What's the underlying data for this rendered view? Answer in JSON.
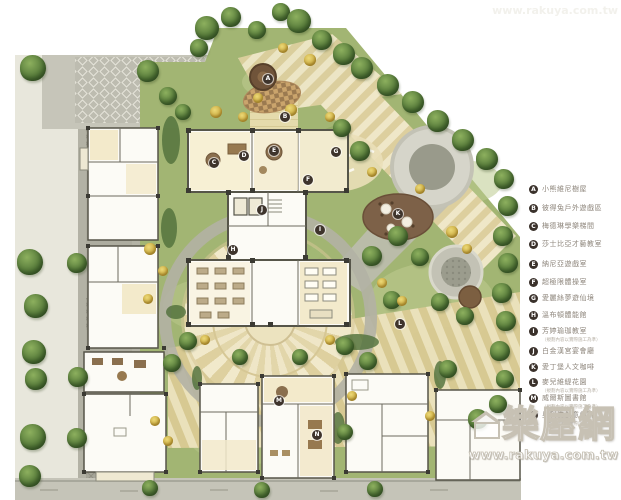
{
  "legend": {
    "items": [
      {
        "letter": "A",
        "label": "小熊維尼樹屋",
        "y": 185
      },
      {
        "letter": "B",
        "label": "彼得兔戶外遊戲區",
        "y": 204
      },
      {
        "letter": "C",
        "label": "梅德琳學樂梯間",
        "y": 222
      },
      {
        "letter": "D",
        "label": "莎士比亞才藝教室",
        "y": 240
      },
      {
        "letter": "E",
        "label": "納尼亞遊戲室",
        "y": 260
      },
      {
        "letter": "F",
        "label": "超極限體操室",
        "y": 278
      },
      {
        "letter": "G",
        "label": "愛麗絲夢遊仙境",
        "y": 294
      },
      {
        "letter": "H",
        "label": "溫布頓體能館",
        "y": 311
      },
      {
        "letter": "I",
        "label": "芳婷瑜珈教室",
        "caption": "（規劃內容以實際施工為準）",
        "y": 327
      },
      {
        "letter": "J",
        "label": "白金漢宮宴會廳",
        "y": 347
      },
      {
        "letter": "K",
        "label": "愛丁堡人文咖啡",
        "y": 363
      },
      {
        "letter": "L",
        "label": "麥兒維緹花園",
        "caption": "（規劃內容以實際施工為準）",
        "y": 378
      },
      {
        "letter": "M",
        "label": "威爾斯圖書館",
        "caption": "（規劃內容以實際施工為準）",
        "y": 394
      },
      {
        "letter": "N",
        "label": "奧利佛創意劇院",
        "caption": "（規劃內容以實際施工為準）",
        "y": 411
      }
    ]
  },
  "watermark": {
    "brand": "樂屋網",
    "url": "www.rakuya.com.tw"
  },
  "plan": {
    "markers": [
      {
        "letter": "A",
        "x": 268,
        "y": 79
      },
      {
        "letter": "B",
        "x": 285,
        "y": 117
      },
      {
        "letter": "C",
        "x": 214,
        "y": 163
      },
      {
        "letter": "D",
        "x": 244,
        "y": 156
      },
      {
        "letter": "E",
        "x": 274,
        "y": 151
      },
      {
        "letter": "F",
        "x": 308,
        "y": 180
      },
      {
        "letter": "G",
        "x": 336,
        "y": 152
      },
      {
        "letter": "H",
        "x": 233,
        "y": 250
      },
      {
        "letter": "I",
        "x": 320,
        "y": 230
      },
      {
        "letter": "J",
        "x": 262,
        "y": 210
      },
      {
        "letter": "K",
        "x": 398,
        "y": 214
      },
      {
        "letter": "L",
        "x": 400,
        "y": 324
      },
      {
        "letter": "M",
        "x": 279,
        "y": 401
      },
      {
        "letter": "N",
        "x": 317,
        "y": 435
      }
    ],
    "trees": [
      [
        33,
        68,
        13
      ],
      [
        148,
        71,
        11
      ],
      [
        30,
        262,
        13
      ],
      [
        36,
        306,
        12
      ],
      [
        34,
        352,
        12
      ],
      [
        36,
        379,
        11
      ],
      [
        33,
        437,
        13
      ],
      [
        30,
        476,
        11
      ],
      [
        77,
        263,
        10
      ],
      [
        78,
        377,
        10
      ],
      [
        77,
        438,
        10
      ],
      [
        207,
        28,
        12
      ],
      [
        231,
        17,
        10
      ],
      [
        257,
        30,
        9
      ],
      [
        281,
        12,
        9
      ],
      [
        299,
        21,
        12
      ],
      [
        322,
        40,
        10
      ],
      [
        199,
        48,
        9
      ],
      [
        344,
        54,
        11
      ],
      [
        362,
        68,
        11
      ],
      [
        388,
        85,
        11
      ],
      [
        413,
        102,
        11
      ],
      [
        438,
        121,
        11
      ],
      [
        463,
        140,
        11
      ],
      [
        487,
        159,
        11
      ],
      [
        504,
        179,
        10
      ],
      [
        508,
        206,
        10
      ],
      [
        503,
        236,
        10
      ],
      [
        508,
        263,
        10
      ],
      [
        502,
        293,
        10
      ],
      [
        506,
        321,
        10
      ],
      [
        500,
        351,
        10
      ],
      [
        505,
        379,
        9
      ],
      [
        498,
        404,
        9
      ],
      [
        168,
        96,
        9
      ],
      [
        183,
        112,
        8
      ],
      [
        342,
        128,
        9
      ],
      [
        360,
        151,
        10
      ],
      [
        398,
        236,
        10
      ],
      [
        372,
        256,
        10
      ],
      [
        420,
        257,
        9
      ],
      [
        392,
        300,
        9
      ],
      [
        440,
        302,
        9
      ],
      [
        465,
        316,
        9
      ],
      [
        188,
        341,
        9
      ],
      [
        172,
        363,
        9
      ],
      [
        345,
        346,
        9
      ],
      [
        368,
        361,
        9
      ],
      [
        448,
        369,
        9
      ],
      [
        478,
        419,
        10
      ],
      [
        345,
        432,
        8
      ],
      [
        240,
        357,
        8
      ],
      [
        300,
        357,
        8
      ],
      [
        150,
        488,
        8
      ],
      [
        262,
        490,
        8
      ],
      [
        375,
        489,
        8
      ]
    ],
    "shrubs": [
      [
        216,
        112,
        6
      ],
      [
        243,
        117,
        5
      ],
      [
        291,
        110,
        6
      ],
      [
        330,
        117,
        5
      ],
      [
        310,
        60,
        6
      ],
      [
        283,
        48,
        5
      ],
      [
        258,
        98,
        5
      ],
      [
        452,
        232,
        6
      ],
      [
        467,
        249,
        5
      ],
      [
        150,
        249,
        6
      ],
      [
        163,
        271,
        5
      ],
      [
        382,
        283,
        5
      ],
      [
        402,
        301,
        5
      ],
      [
        148,
        299,
        5
      ],
      [
        372,
        172,
        5
      ],
      [
        420,
        189,
        5
      ],
      [
        155,
        421,
        5
      ],
      [
        168,
        441,
        5
      ],
      [
        352,
        396,
        5
      ],
      [
        430,
        416,
        5
      ],
      [
        205,
        340,
        5
      ],
      [
        330,
        340,
        5
      ]
    ],
    "colors": {
      "lawn": "#a2b573",
      "road": "#b3b2a5",
      "walkway": "#efe7c8",
      "plaza": "#c6c5b9",
      "marker": "#3e342c"
    }
  }
}
